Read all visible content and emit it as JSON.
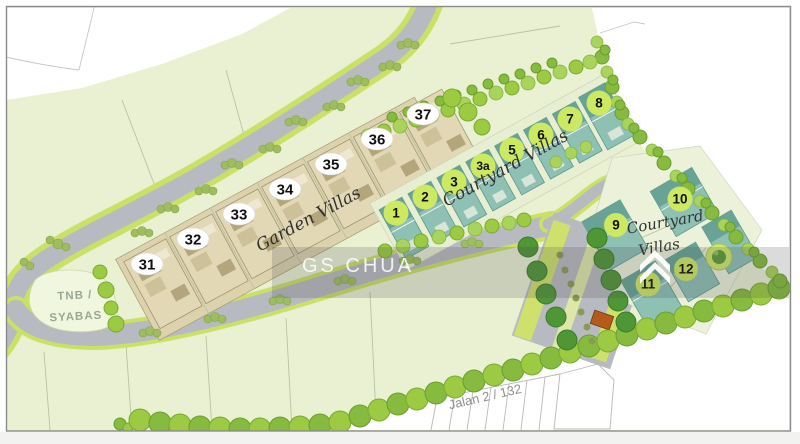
{
  "plan": {
    "watermark": {
      "text": "GS CHUA",
      "logo": "double-chevron-icon"
    },
    "labels": {
      "garden_villas": "Garden Villas",
      "courtyard_villas_row": "Courtyard Villas",
      "courtyard_cluster_line1": "Courtyard",
      "courtyard_cluster_line2": "Villas",
      "utility_lot_line1": "TNB /",
      "utility_lot_line2": "SYABAS",
      "road_name": "Jalan 2 / 132"
    },
    "garden_villas_lots": [
      "31",
      "32",
      "33",
      "34",
      "35",
      "36",
      "37"
    ],
    "courtyard_villas_lots": [
      "1",
      "2",
      "3",
      "3a",
      "5",
      "6",
      "7",
      "8"
    ],
    "courtyard_cluster_lots": [
      "9",
      "10",
      "11",
      "12"
    ],
    "colors": {
      "parcel_green": "#e9f1d2",
      "road_gray": "#b7bac0",
      "verge_lime": "#cbe166",
      "tree_green": "#9cca42",
      "dark_tree_green": "#4f9636",
      "villa_teal": "#8fc0b4",
      "villa_beige": "#e2d8b6",
      "lot_number_circle": "#cde961",
      "utility_parcel": "#f1f7de"
    }
  }
}
